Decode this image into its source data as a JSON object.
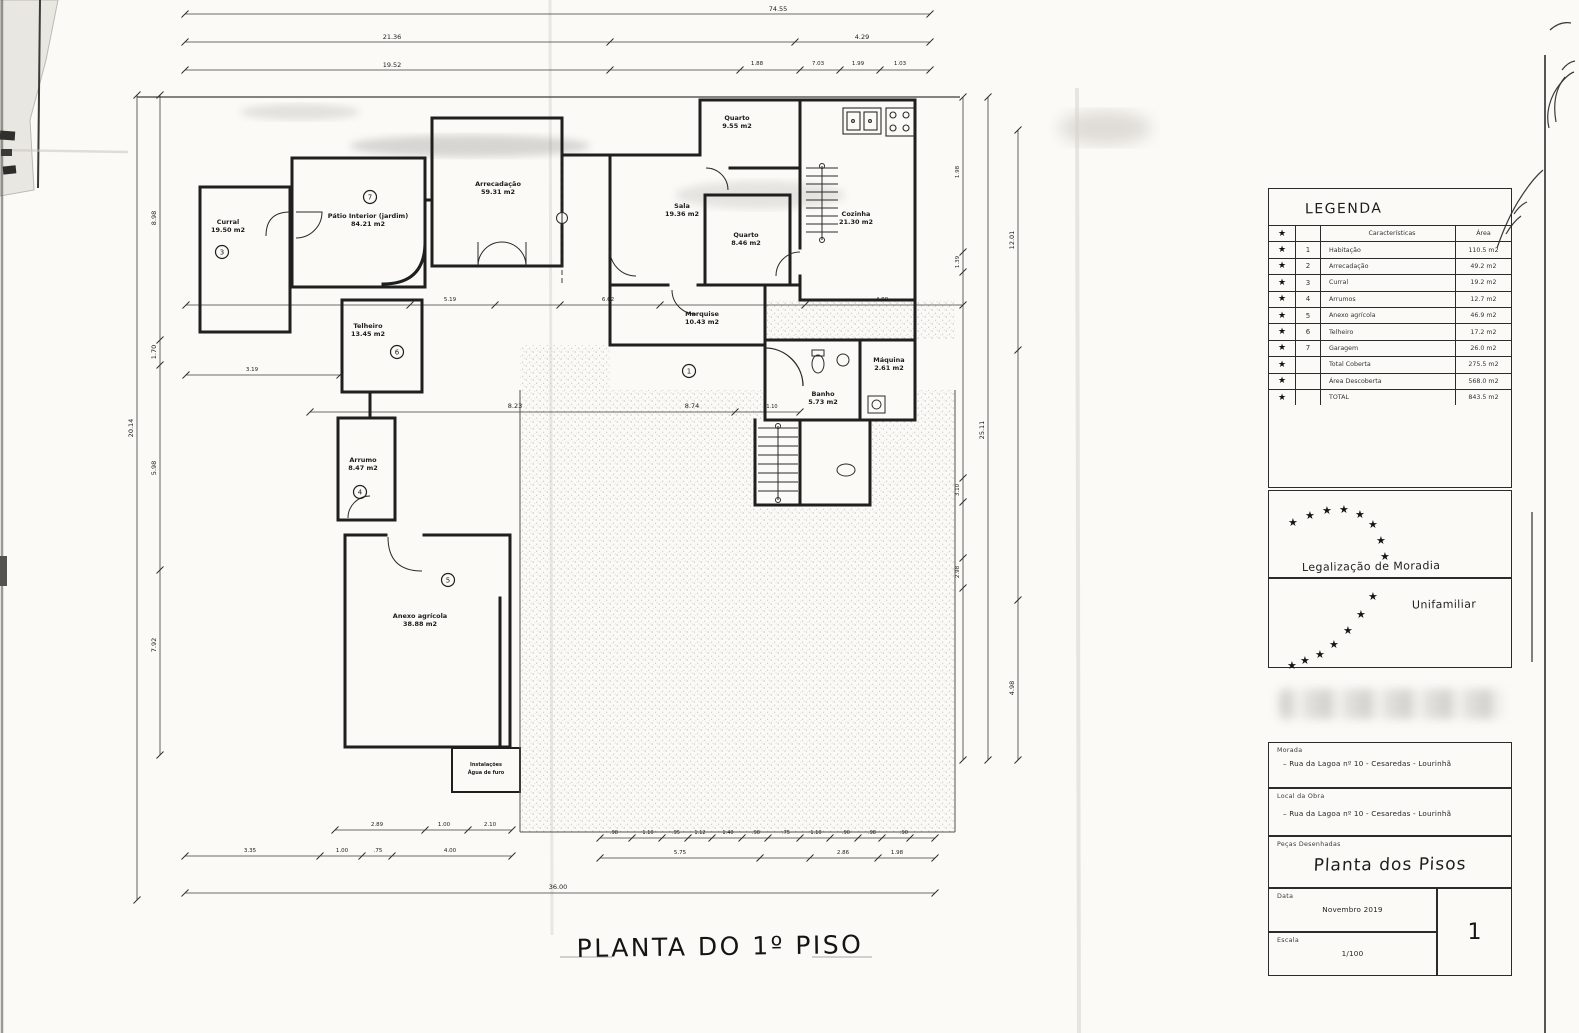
{
  "page": {
    "bottom_title": "PLANTA DO 1º PISO"
  },
  "legend": {
    "title": "LEGENDA",
    "star_glyph": "★",
    "header": {
      "num": "",
      "desc": "Características",
      "area": "Área"
    },
    "rows": [
      {
        "num": "1",
        "desc": "Habitação",
        "area": "110.5 m2"
      },
      {
        "num": "2",
        "desc": "Arrecadação",
        "area": "49.2 m2"
      },
      {
        "num": "3",
        "desc": "Curral",
        "area": "19.2 m2"
      },
      {
        "num": "4",
        "desc": "Arrumos",
        "area": "12.7 m2"
      },
      {
        "num": "5",
        "desc": "Anexo agrícola",
        "area": "46.9 m2"
      },
      {
        "num": "6",
        "desc": "Telheiro",
        "area": "17.2 m2"
      },
      {
        "num": "7",
        "desc": "Garagem",
        "area": "26.0 m2"
      },
      {
        "num": "",
        "desc": "Total Coberta",
        "area": "275.5 m2"
      },
      {
        "num": "",
        "desc": "Área Descoberta",
        "area": "568.0 m2"
      },
      {
        "num": "",
        "desc": "TOTAL",
        "area": "843.5 m2"
      }
    ]
  },
  "project": {
    "line1": "Legalização de Moradia",
    "line2": "Unifamiliar"
  },
  "title_block": {
    "morada_label": "Morada",
    "morada_value": "– Rua da Lagoa nº 10  -  Cesaredas  -  Lourinhã",
    "local_label": "Local da Obra",
    "local_value": "– Rua da Lagoa nº 10  -  Cesaredas  -  Lourinhã",
    "pecas_label": "Peças Desenhadas",
    "pecas_value": "Planta dos Pisos",
    "data_label": "Data",
    "data_value": "Novembro 2019",
    "escala_label": "Escala",
    "escala_value": "1/100",
    "sheet_number": "1"
  },
  "plan": {
    "rooms": [
      {
        "name": "Curral",
        "area": "19.50 m2",
        "x": 228,
        "y": 224,
        "num": "3",
        "nx": 222,
        "ny": 252
      },
      {
        "name": "Pátio Interior (jardim)",
        "area": "84.21 m2",
        "x": 368,
        "y": 218,
        "num": "7",
        "nx": 370,
        "ny": 197
      },
      {
        "name": "Arrecadação",
        "area": "59.31 m2",
        "x": 498,
        "y": 186
      },
      {
        "name": "Sala",
        "area": "19.36 m2",
        "x": 682,
        "y": 208
      },
      {
        "name": "Quarto",
        "area": "9.55 m2",
        "x": 737,
        "y": 120
      },
      {
        "name": "Quarto",
        "area": "8.46 m2",
        "x": 746,
        "y": 237
      },
      {
        "name": "Cozinha",
        "area": "21.30 m2",
        "x": 856,
        "y": 216
      },
      {
        "name": "Telheiro",
        "area": "13.45 m2",
        "x": 368,
        "y": 328,
        "num": "6",
        "nx": 397,
        "ny": 352
      },
      {
        "name": "Marquise",
        "area": "10.43 m2",
        "x": 702,
        "y": 316
      },
      {
        "name": "Banho",
        "area": "5.73 m2",
        "x": 823,
        "y": 396
      },
      {
        "name": "Máquina",
        "area": "2.61 m2",
        "x": 889,
        "y": 362
      },
      {
        "name": "Arrumo",
        "area": "8.47 m2",
        "x": 363,
        "y": 462,
        "num": "4",
        "nx": 360,
        "ny": 492
      },
      {
        "name": "Anexo agrícola",
        "area": "38.88 m2",
        "x": 420,
        "y": 618,
        "num": "5",
        "nx": 448,
        "ny": 580
      },
      {
        "name": "Instalações",
        "area": "Água de furo",
        "x": 486,
        "y": 766,
        "s": 5
      },
      {
        "name": "",
        "area": "",
        "x": 0,
        "y": 0,
        "num": "1",
        "nx": 689,
        "ny": 371
      }
    ],
    "dims": [
      {
        "t": "74.55",
        "x": 778,
        "y": 11
      },
      {
        "t": "21.36",
        "x": 392,
        "y": 39
      },
      {
        "t": "4.29",
        "x": 862,
        "y": 39
      },
      {
        "t": "19.52",
        "x": 392,
        "y": 67
      },
      {
        "t": "1.88",
        "x": 757,
        "y": 65,
        "s": 5.5
      },
      {
        "t": "7.03",
        "x": 818,
        "y": 65,
        "s": 5.5
      },
      {
        "t": "1.99",
        "x": 858,
        "y": 65,
        "s": 5.5
      },
      {
        "t": "1.03",
        "x": 900,
        "y": 65,
        "s": 5.5
      },
      {
        "t": "20.14",
        "x": 133,
        "y": 428,
        "r": -90
      },
      {
        "t": "8.98",
        "x": 156,
        "y": 218,
        "r": -90
      },
      {
        "t": "1.70",
        "x": 156,
        "y": 352,
        "r": -90
      },
      {
        "t": "5.98",
        "x": 156,
        "y": 468,
        "r": -90
      },
      {
        "t": "7.92",
        "x": 156,
        "y": 645,
        "r": -90
      },
      {
        "t": "1.98",
        "x": 959,
        "y": 172,
        "r": -90,
        "s": 5.5
      },
      {
        "t": "12.01",
        "x": 1014,
        "y": 240,
        "r": -90
      },
      {
        "t": "1.39",
        "x": 959,
        "y": 262,
        "r": -90,
        "s": 5.5
      },
      {
        "t": "25.11",
        "x": 984,
        "y": 430,
        "r": -90
      },
      {
        "t": "3.10",
        "x": 959,
        "y": 490,
        "r": -90,
        "s": 5.5
      },
      {
        "t": "2.98",
        "x": 959,
        "y": 572,
        "r": -90,
        "s": 5.5
      },
      {
        "t": "4.98",
        "x": 1014,
        "y": 688,
        "r": -90
      },
      {
        "t": "5.19",
        "x": 450,
        "y": 301,
        "s": 5.5
      },
      {
        "t": "6.62",
        "x": 608,
        "y": 301,
        "s": 5.5
      },
      {
        "t": "4.88",
        "x": 882,
        "y": 301,
        "s": 5.5
      },
      {
        "t": "3.19",
        "x": 252,
        "y": 371,
        "s": 5.5
      },
      {
        "t": "8.23",
        "x": 515,
        "y": 408
      },
      {
        "t": "8.74",
        "x": 692,
        "y": 408
      },
      {
        "t": "1.10",
        "x": 772,
        "y": 408,
        "s": 5
      },
      {
        "t": "2.89",
        "x": 377,
        "y": 826,
        "s": 5.5
      },
      {
        "t": "1.00",
        "x": 444,
        "y": 826,
        "s": 5.5
      },
      {
        "t": "2.10",
        "x": 490,
        "y": 826,
        "s": 5.5
      },
      {
        "t": "3.35",
        "x": 250,
        "y": 852,
        "s": 5.5
      },
      {
        "t": "1.00",
        "x": 342,
        "y": 852,
        "s": 5.5
      },
      {
        "t": ".75",
        "x": 378,
        "y": 852,
        "s": 5.5
      },
      {
        "t": "4.00",
        "x": 450,
        "y": 852,
        "s": 5.5
      },
      {
        "t": "5.75",
        "x": 680,
        "y": 854,
        "s": 5.5
      },
      {
        "t": "2.86",
        "x": 843,
        "y": 854,
        "s": 5.5
      },
      {
        "t": "1.98",
        "x": 897,
        "y": 854,
        "s": 5.5
      },
      {
        "t": "36.00",
        "x": 558,
        "y": 889
      },
      {
        "t": ".98",
        "x": 614,
        "y": 834,
        "s": 5
      },
      {
        "t": "1.10",
        "x": 648,
        "y": 834,
        "s": 5
      },
      {
        "t": ".95",
        "x": 676,
        "y": 834,
        "s": 5
      },
      {
        "t": "1.12",
        "x": 700,
        "y": 834,
        "s": 5
      },
      {
        "t": "1.40",
        "x": 728,
        "y": 834,
        "s": 5
      },
      {
        "t": ".98",
        "x": 756,
        "y": 834,
        "s": 5
      },
      {
        "t": ".75",
        "x": 786,
        "y": 834,
        "s": 5
      },
      {
        "t": "1.10",
        "x": 816,
        "y": 834,
        "s": 5
      },
      {
        "t": ".90",
        "x": 846,
        "y": 834,
        "s": 5
      },
      {
        "t": ".98",
        "x": 872,
        "y": 834,
        "s": 5
      },
      {
        "t": ".90",
        "x": 904,
        "y": 834,
        "s": 5
      }
    ]
  }
}
